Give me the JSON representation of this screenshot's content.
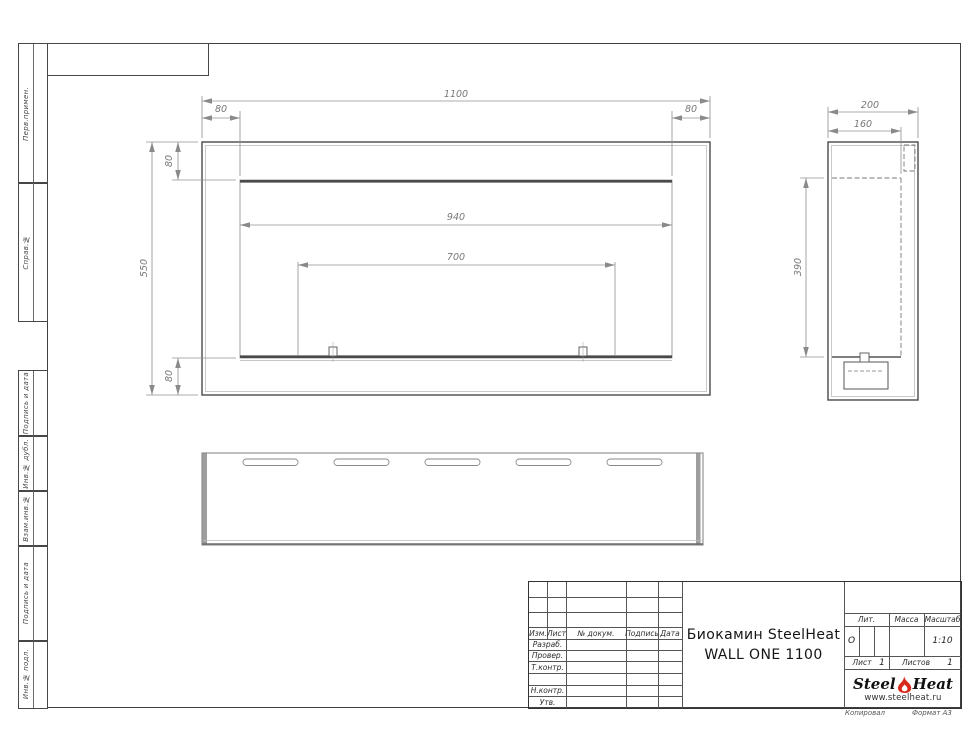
{
  "frame": {
    "left_labels": [
      "Перв.примен.",
      "Справ.№",
      "Подпись и дата",
      "Инв.№ дубл.",
      "Взам.инв.№",
      "Подпись и дата",
      "Инв.№ подл."
    ]
  },
  "views": {
    "front": {
      "dims": {
        "overall_width": "1100",
        "left_margin": "80",
        "right_margin": "80",
        "top_margin": "80",
        "bottom_margin": "80",
        "overall_height": "550",
        "opening_width": "940",
        "burner_width": "700"
      }
    },
    "side": {
      "dims": {
        "depth": "200",
        "inner_depth": "160",
        "opening_height": "390"
      }
    }
  },
  "title_block": {
    "header_cols": [
      "Изм.",
      "Лист",
      "№ докум.",
      "Подпись",
      "Дата"
    ],
    "rows": [
      "Разраб.",
      "Провер.",
      "Т.контр.",
      "Н.контр.",
      "Утв."
    ],
    "title_line1": "Биокамин SteelHeat",
    "title_line2": "WALL ONE 1100",
    "lit_label": "Лит.",
    "lit_value": "О",
    "mass_label": "Масса",
    "scale_label": "Масштаб",
    "scale_value": "1:10",
    "sheet_label": "Лист",
    "sheet_value": "1",
    "sheets_label": "Листов",
    "sheets_value": "1",
    "logo": {
      "part1": "Steel",
      "part2": "Heat",
      "url": "www.steelheat.ru",
      "flame_color": "#d9291c"
    },
    "footer_left": "Копировал",
    "footer_right": "Формат А3"
  }
}
